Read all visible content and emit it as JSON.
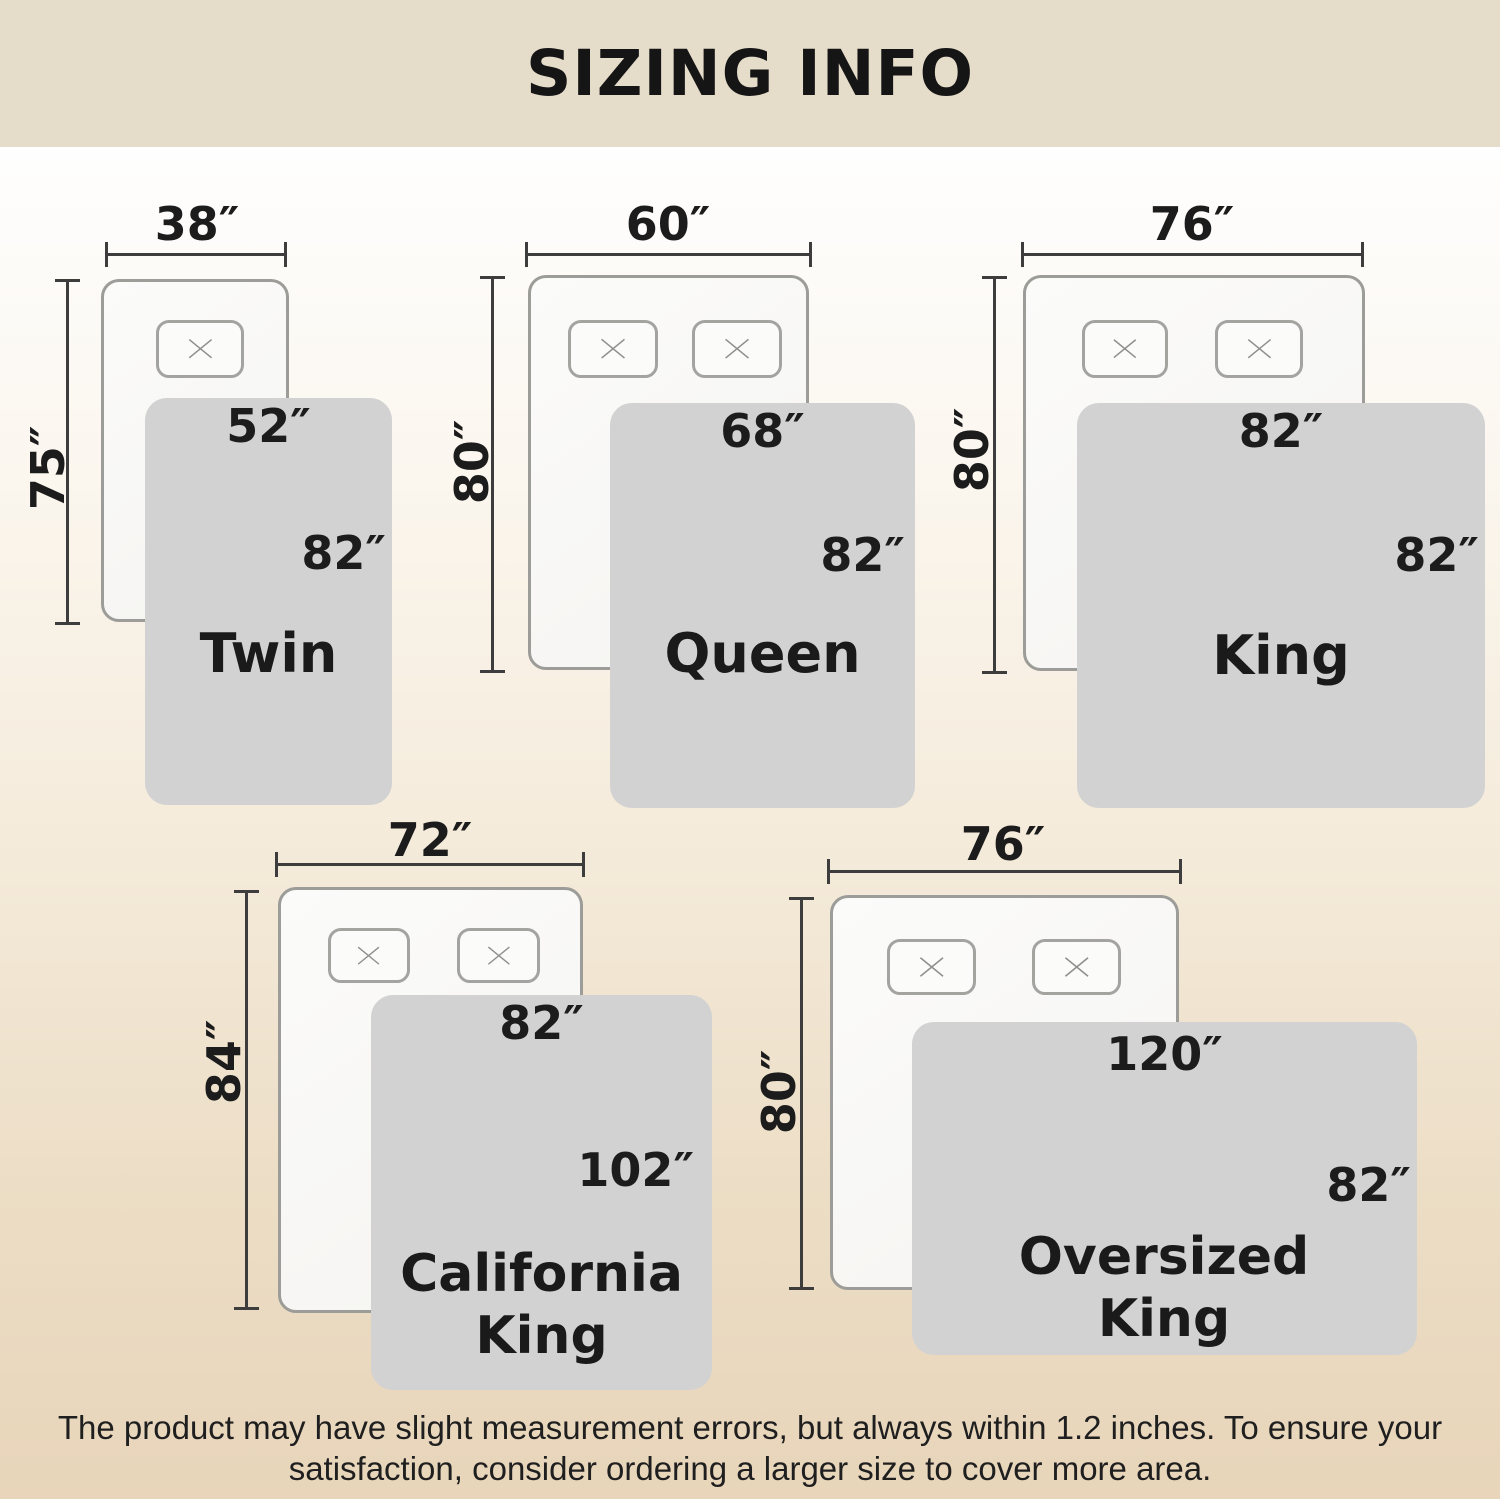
{
  "header": {
    "title": "SIZING INFO"
  },
  "sizes": [
    {
      "name": "Twin",
      "mattress_width": "38″",
      "mattress_length": "75″",
      "blanket_width": "52″",
      "blanket_length": "82″"
    },
    {
      "name": "Queen",
      "mattress_width": "60″",
      "mattress_length": "80″",
      "blanket_width": "68″",
      "blanket_length": "82″"
    },
    {
      "name": "King",
      "mattress_width": "76″",
      "mattress_length": "80″",
      "blanket_width": "82″",
      "blanket_length": "82″"
    },
    {
      "name": "California King",
      "mattress_width": "72″",
      "mattress_length": "84″",
      "blanket_width": "82″",
      "blanket_length": "102″"
    },
    {
      "name": "Oversized King",
      "mattress_width": "76″",
      "mattress_length": "80″",
      "blanket_width": "120″",
      "blanket_length": "82″"
    }
  ],
  "footer": {
    "line1": "The product may have slight measurement errors, but always within 1.2 inches. To ensure your",
    "line2": "satisfaction, consider ordering a larger size to cover more area."
  },
  "colors": {
    "banner": "#e6dcca",
    "background_bottom": "#e8d5ba",
    "blanket": "#d2d2d2",
    "mattress_border": "#9c9c98",
    "dimension_line": "#3d3d3d",
    "text": "#1c1c1c"
  }
}
